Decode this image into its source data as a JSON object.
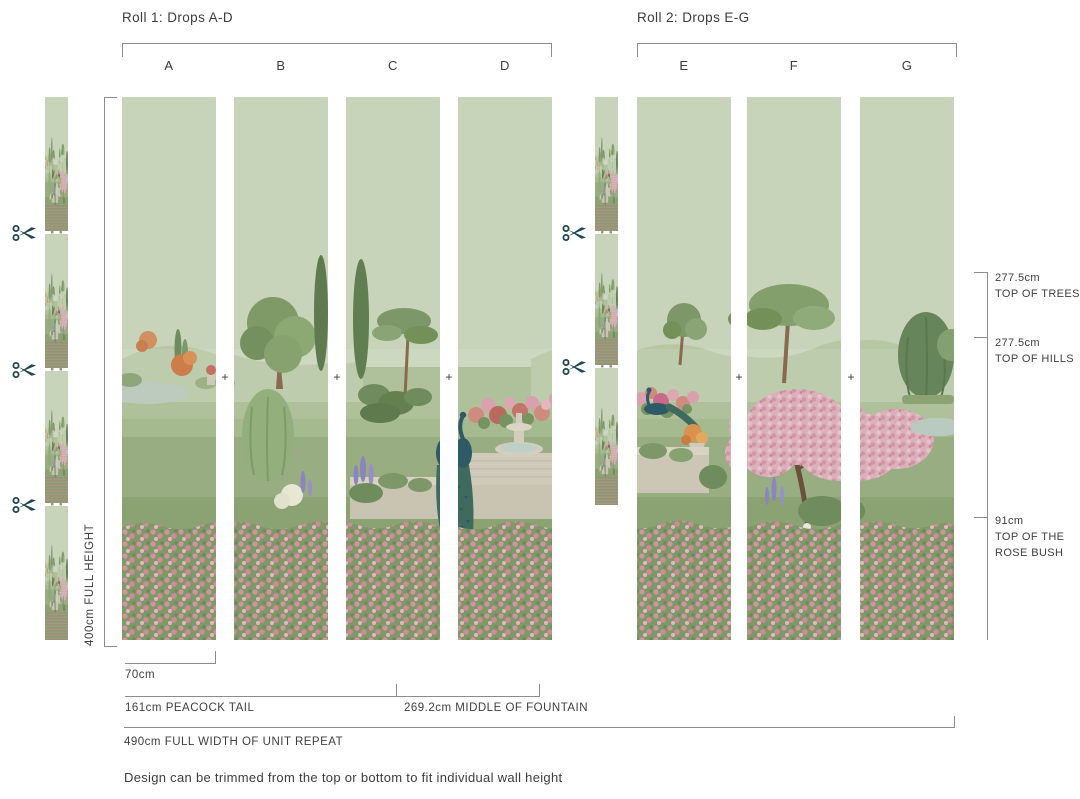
{
  "diagram": {
    "rolls": [
      {
        "title": "Roll 1: Drops A-D",
        "drops": [
          "A",
          "B",
          "C",
          "D"
        ]
      },
      {
        "title": "Roll 2: Drops E-G",
        "drops": [
          "E",
          "F",
          "G"
        ]
      }
    ],
    "left_dimension": {
      "label": "400cm FULL HEIGHT"
    },
    "right_annotations": [
      {
        "value": "277.5cm",
        "label": "TOP OF TREES"
      },
      {
        "value": "277.5cm",
        "label": "TOP OF HILLS"
      },
      {
        "value": "91cm",
        "label": "TOP OF THE ROSE BUSH"
      }
    ],
    "bottom_dimensions": {
      "drop_width": "70cm",
      "peacock_tail": "161cm PEACOCK TAIL",
      "middle_of_fountain": "269.2cm MIDDLE OF FOUNTAIN",
      "full_width": "490cm FULL WIDTH OF UNIT REPEAT"
    },
    "note": "Design can be trimmed from the top or bottom to fit individual wall height",
    "register_mark": "+",
    "icons": {
      "scissors": "scissors-icon"
    },
    "colors": {
      "sky": "#c8d4b9",
      "rose_pink": "#d294a0",
      "blossom_pink": "#dcb0ba",
      "scissors": "#1d4650",
      "text": "#3f3f3f",
      "dimension_line": "#8c8c8c"
    }
  }
}
